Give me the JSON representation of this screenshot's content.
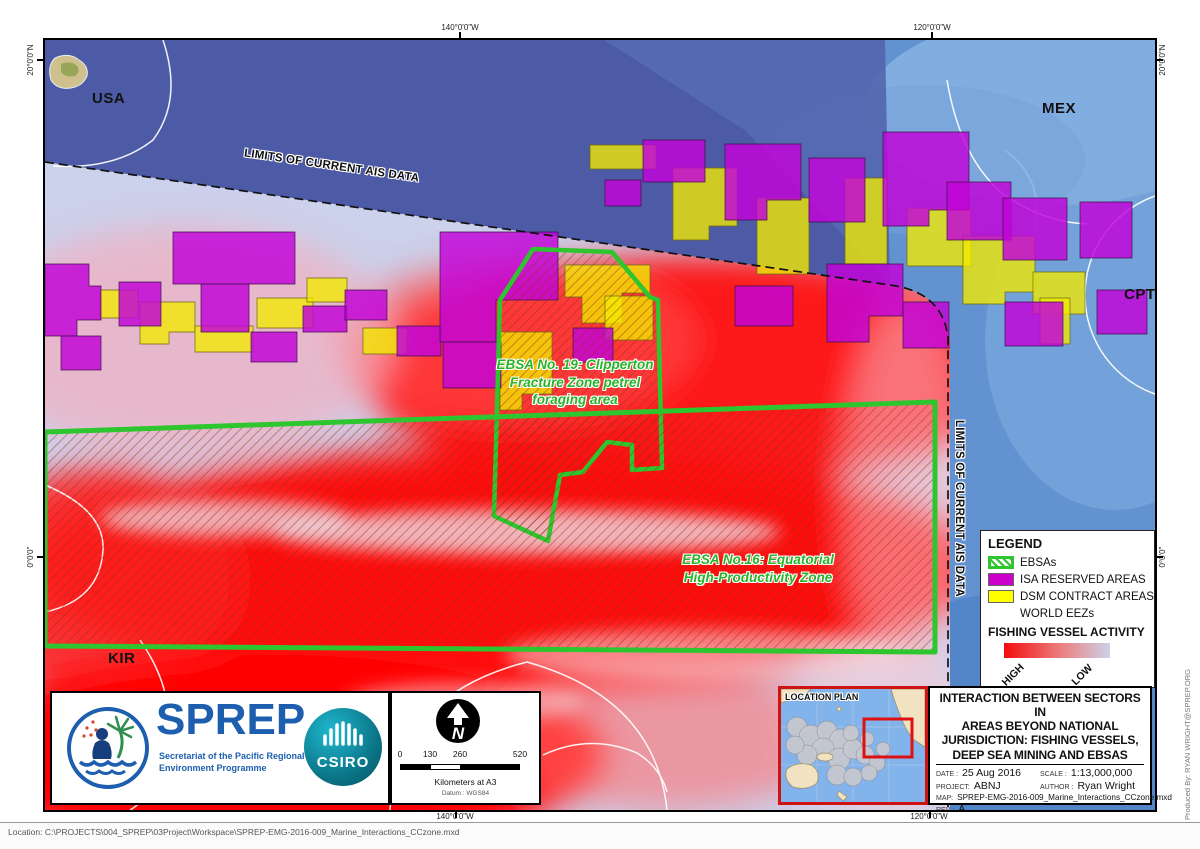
{
  "window": {
    "status_bar": "Location: C:\\PROJECTS\\004_SPREP\\03Project\\Workspace\\SPREP-EMG-2016-009_Marine_Interactions_CCzone.mxd",
    "produced_by": "Produced By: RYAN WRIGHT@SPREP.ORG"
  },
  "graticule": {
    "lon_140w": "140°0'0\"W",
    "lon_120w": "120°0'0\"W",
    "lat_20n": "20°0'0\"N",
    "lat_0": "0°0'0\""
  },
  "countries": {
    "usa": "USA",
    "mex": "MEX",
    "cpt": "CPT",
    "kir": "KIR"
  },
  "map_labels": {
    "ais_limit": "LIMITS OF CURRENT AIS DATA",
    "ebsa19_lines": [
      "EBSA No. 19: Clipperton",
      "Fracture Zone petrel",
      "foraging area"
    ],
    "ebsa16_lines": [
      "EBSA No.16: Equatorial",
      "High-Productivity Zone"
    ]
  },
  "legend": {
    "title": "LEGEND",
    "items": [
      {
        "label": "EBSAs",
        "swatch": "green-hatched"
      },
      {
        "label": "ISA RESERVED AREAS",
        "swatch": "purple"
      },
      {
        "label": "DSM CONTRACT AREAS",
        "swatch": "yellow"
      },
      {
        "label": "WORLD EEZs",
        "swatch": "none"
      }
    ],
    "fishing_title": "FISHING VESSEL ACTIVITY",
    "high": "HIGH",
    "low": "LOW"
  },
  "scale_bar": {
    "ticks": [
      "0",
      "130",
      "260",
      "520"
    ],
    "unit": "Kilometers at A3",
    "datum": "Datum : WGS84"
  },
  "logos": {
    "sprep": "SPREP",
    "sprep_sub1": "Secretariat of the Pacific Regional",
    "sprep_sub2": "Environment Programme",
    "csiro": "CSIRO"
  },
  "location_plan": {
    "title": "LOCATION PLAN"
  },
  "title_block": {
    "title_lines": [
      "INTERACTION BETWEEN SECTORS IN",
      "AREAS BEYOND NATIONAL",
      "JURISDICTION: FISHING VESSELS,",
      "DEEP SEA MINING AND EBSAS"
    ],
    "date_label": "DATE :",
    "date": "25 Aug 2016",
    "scale_label": "SCALE :",
    "scale": "1:13,000,000",
    "project_label": "PROJECT:",
    "project": "ABNJ",
    "author_label": "AUTHOR :",
    "author": "Ryan Wright",
    "map_label": "MAP:",
    "map": "SPREP-EMG-2016-009_Marine_Interactions_CCzone.mxd",
    "rev_label": "REV :",
    "rev": "A"
  },
  "colors": {
    "ebsa_green": "#33cc33",
    "isa_purple": "#cb00cb",
    "dsm_yellow": "#ffff00",
    "heat_high": "#ff0000",
    "heat_low": "#ccd1e9",
    "ocean": "#6392d0",
    "deep_band": "#4d5ba6",
    "inset_frame": "#cf1212"
  }
}
